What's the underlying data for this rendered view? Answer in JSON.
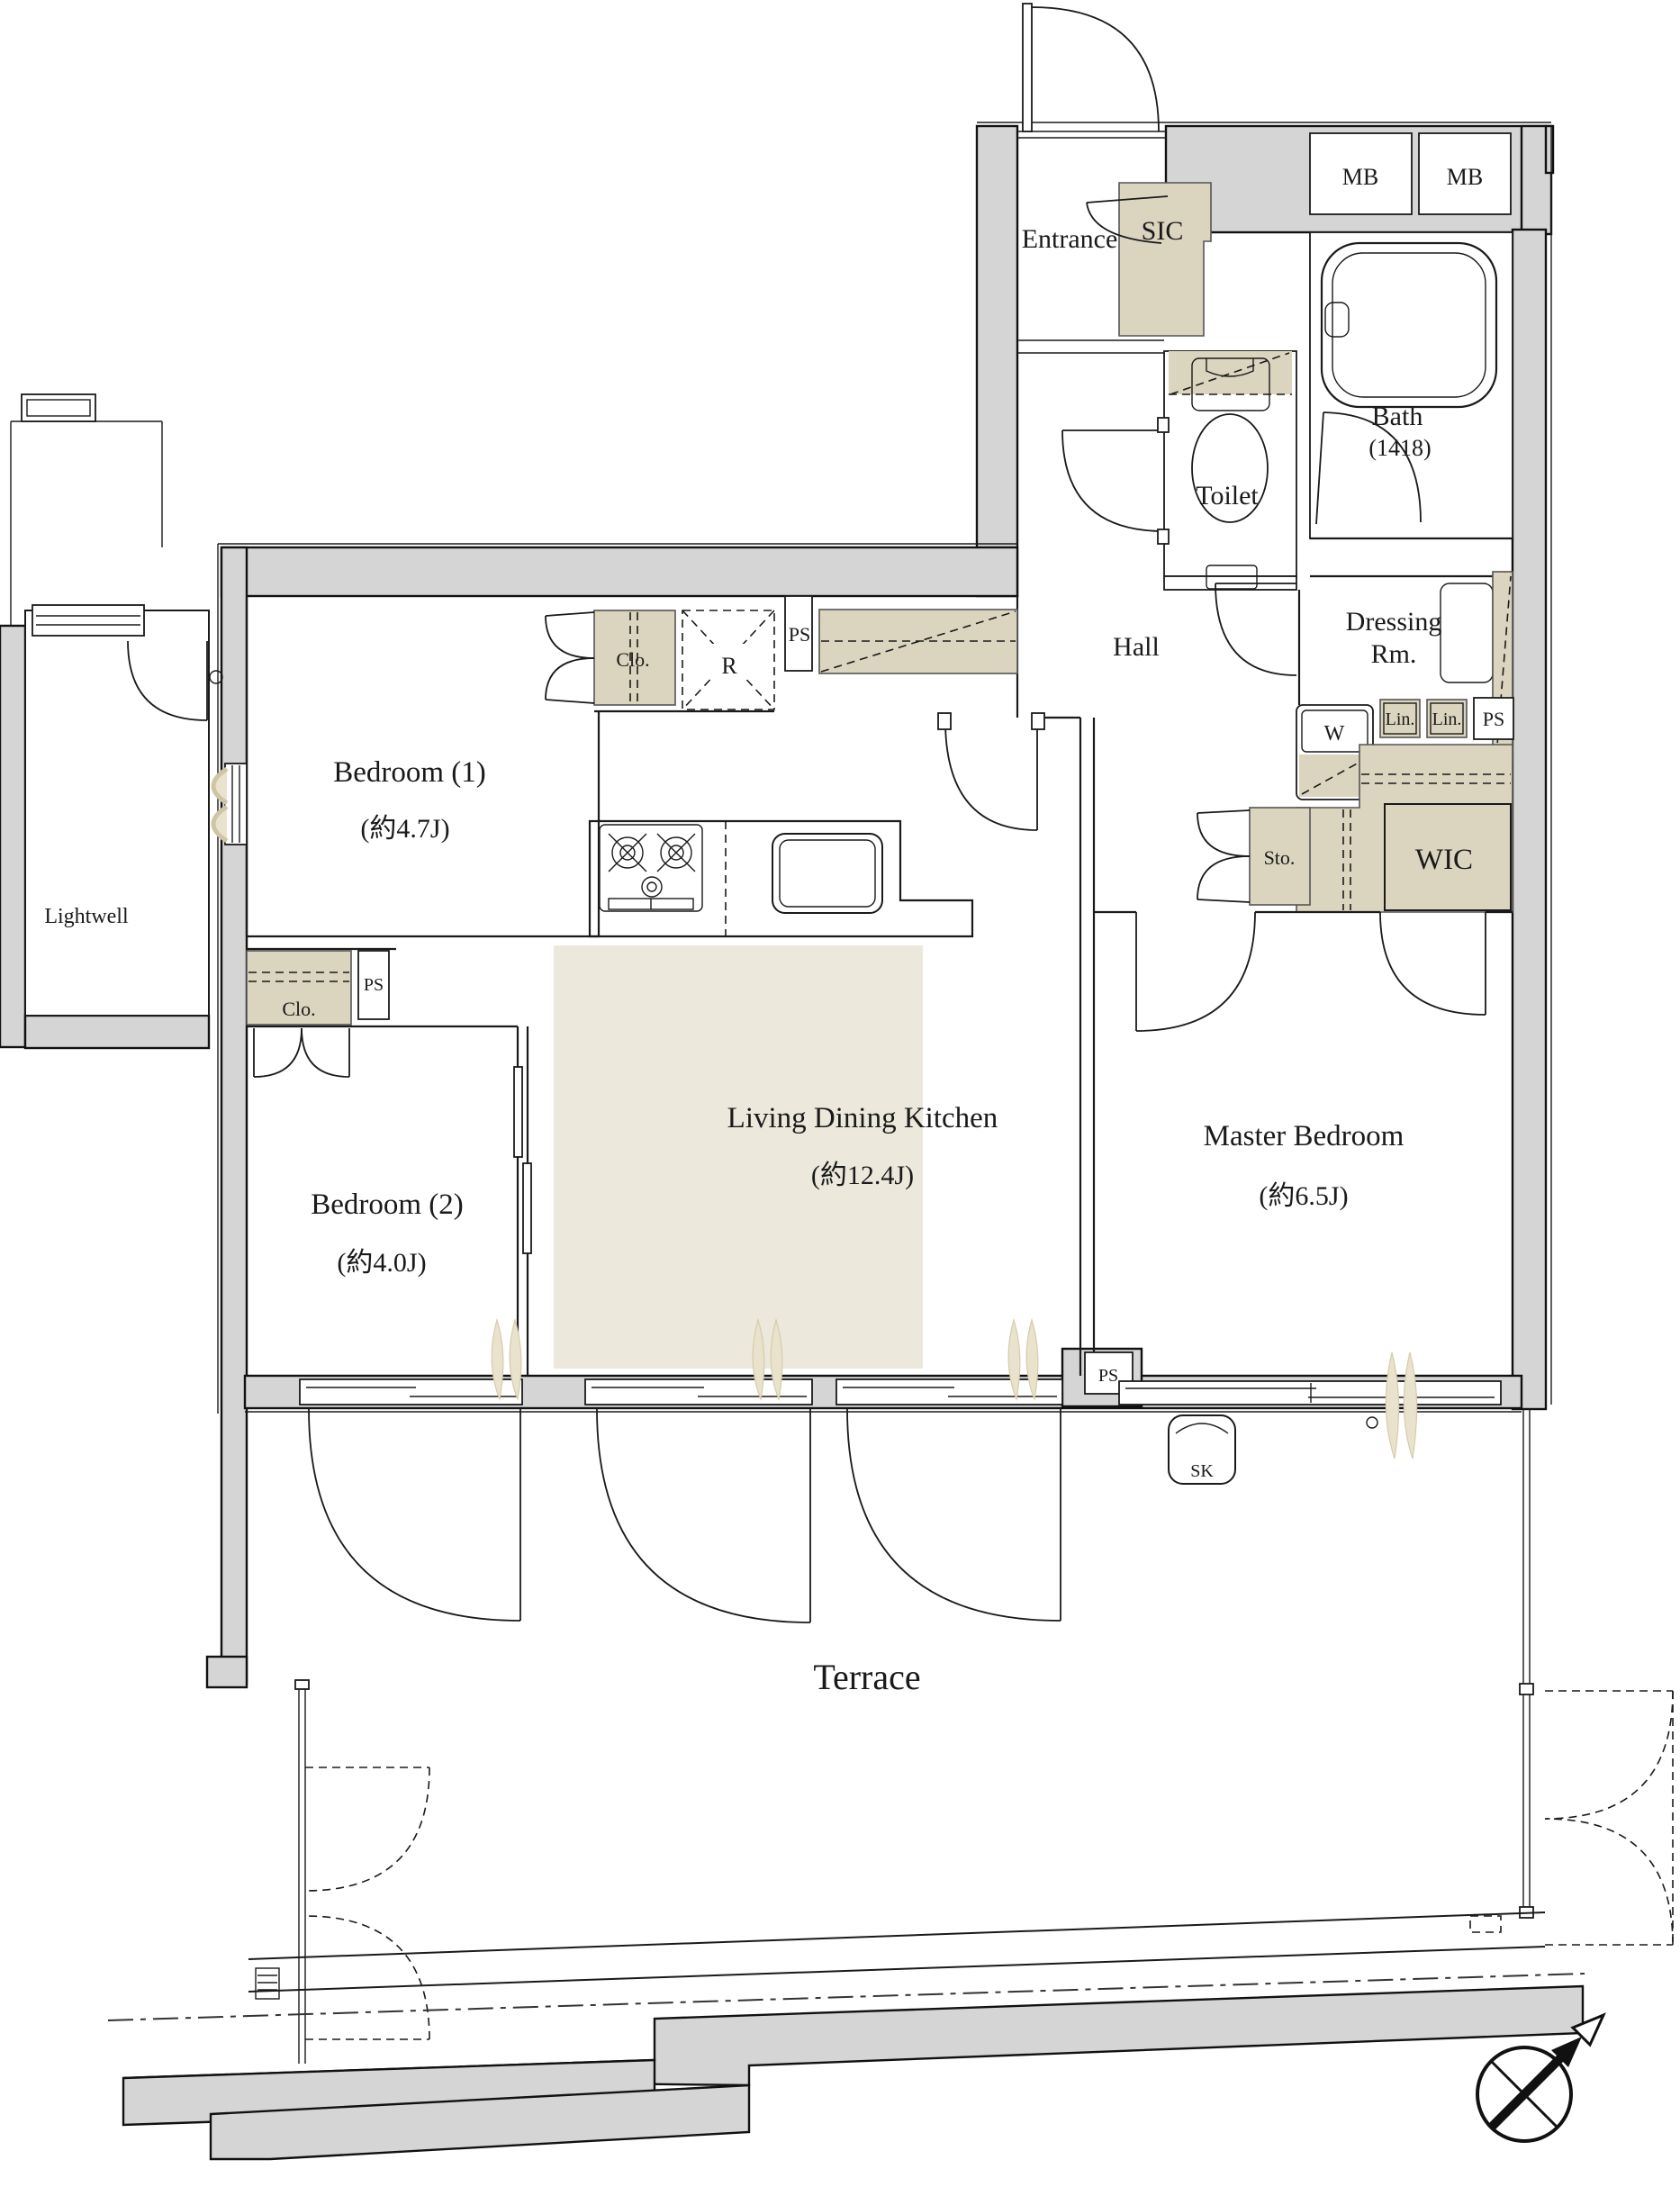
{
  "title": "apartment-floor-plan",
  "colors": {
    "wall_gray": "#d5d5d5",
    "fixture_beige": "#dbd4be",
    "ldk_floor_beige": "#ece8dc",
    "curtain_beige": "#e9e2cd",
    "line_black": "#1a1a1a"
  },
  "rooms": {
    "entrance": "Entrance",
    "sic": "SIC",
    "bath": "Bath",
    "bath_size": "(1418)",
    "toilet": "Toilet",
    "hall": "Hall",
    "dressing_line1": "Dressing",
    "dressing_line2": "Rm.",
    "wic": "WIC",
    "bedroom1": "Bedroom (1)",
    "bedroom1_size": "(約4.7J)",
    "bedroom2": "Bedroom (2)",
    "bedroom2_size": "(約4.0J)",
    "ldk": "Living Dining Kitchen",
    "ldk_size": "(約12.4J)",
    "master": "Master Bedroom",
    "master_size": "(約6.5J)",
    "lightwell": "Lightwell",
    "terrace": "Terrace"
  },
  "fixtures": {
    "mb_left": "MB",
    "mb_right": "MB",
    "washer": "W",
    "lin_left": "Lin.",
    "lin_right": "Lin.",
    "ps_dressing": "PS",
    "sto": "Sto.",
    "clo_bedroom1": "Clo.",
    "clo_bedroom2": "Clo.",
    "refrigerator": "R",
    "ps_kitchen": "PS",
    "ps_bedroom2": "PS",
    "ps_ldk": "PS",
    "sk": "SK"
  }
}
